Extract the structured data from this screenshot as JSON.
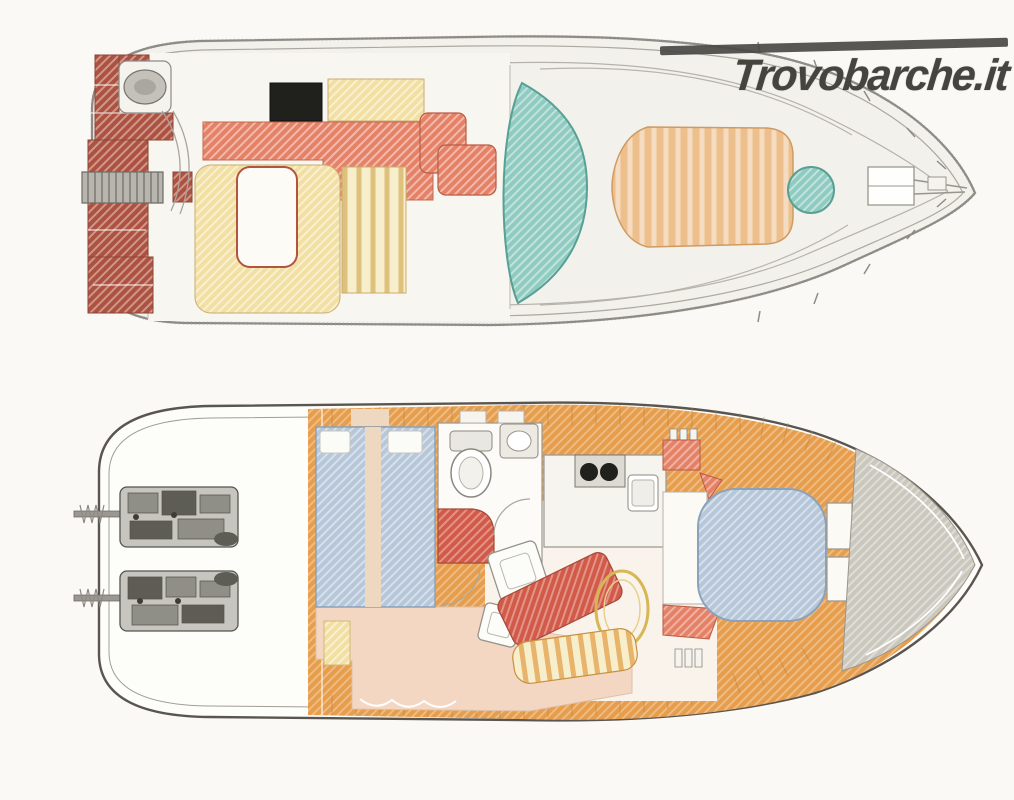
{
  "watermark": {
    "text": "Trovobarche.it",
    "color": "#45443f",
    "bar_color": "#4a4945"
  },
  "palette": {
    "page_bg": "#faf9f6",
    "hull_fill": "#f2f1ec",
    "hull_stroke": "#8c8a84",
    "inner_line": "#aba89f",
    "lower_hull_fill": "#fdfdfa",
    "lower_hull_stroke": "#5a554e",
    "platform_red": "#ad5240",
    "salmon": "#e58166",
    "seat_red": "#d25a48",
    "cream": "#f2dfa2",
    "cream_light": "#f7eecb",
    "teal": "#8fcbc0",
    "teal_stroke": "#56a193",
    "tan": "#ecbf8d",
    "orange_deck": "#e69d4c",
    "plank_seam": "#c58436",
    "blue_bed": "#b6c7d9",
    "blue_stroke": "#8ba2bc",
    "peach": "#f3d7c3",
    "beige": "#eed8bf",
    "bow_gray": "#cac7bd",
    "grill_black": "#20201d",
    "engine_dark": "#5d5c55",
    "engine_mid": "#8f8e87",
    "engine_light": "#c6c5bf",
    "salon_floor": "#faf3eb",
    "off_white": "#f7f6f1",
    "white": "#ffffff"
  },
  "decks": {
    "upper": {
      "regions": [
        "swim-platform",
        "boarding-ladder",
        "liferaft-locker",
        "flybridge-stairs",
        "cockpit-wet-bar",
        "grill-hatch",
        "cockpit-bench",
        "u-shaped-settee",
        "cockpit-table",
        "sun-lounger-bench",
        "helm-seats",
        "windscreen-arch",
        "foredeck-walkways",
        "foredeck-sunpad",
        "bow-hatch",
        "anchor-locker",
        "bow-pulpit"
      ]
    },
    "lower": {
      "regions": [
        "engine-room",
        "port-engine",
        "starboard-engine",
        "aft-cabin-berths",
        "berth-pillows",
        "head-toilet",
        "head-sink",
        "galley-stove",
        "galley-sink",
        "salon-floor",
        "salon-chairs",
        "salon-sofa",
        "salon-table",
        "curved-settee",
        "wardrobe",
        "v-berth",
        "side-shelves",
        "bow-stowage"
      ]
    }
  }
}
